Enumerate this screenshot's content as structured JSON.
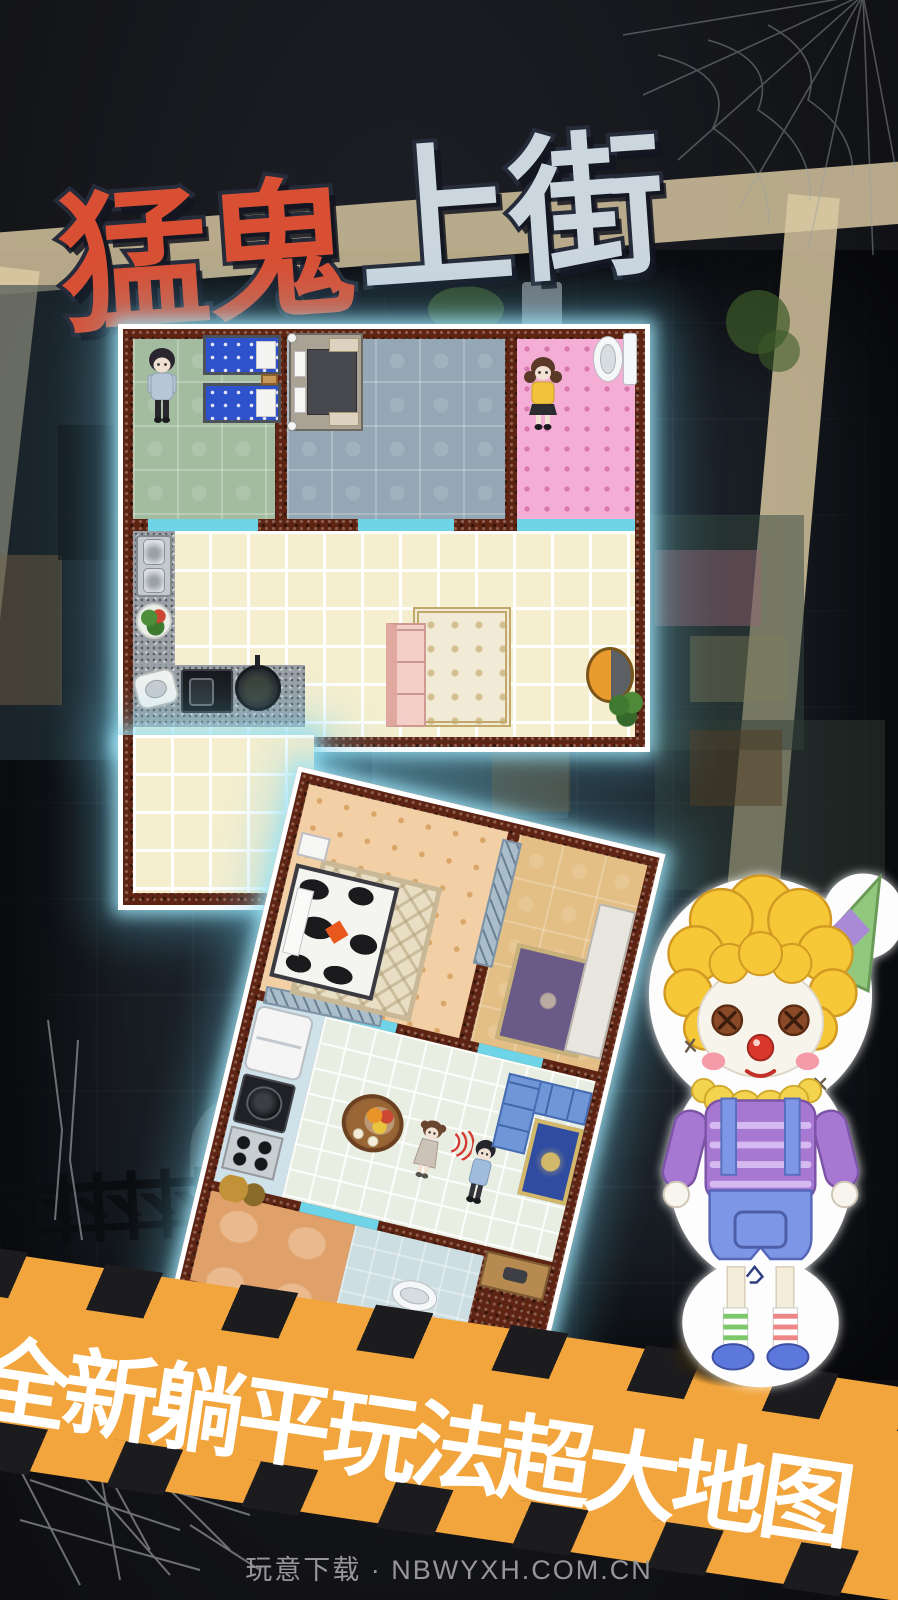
{
  "title": {
    "red": "猛鬼",
    "silver": "上街"
  },
  "banner": {
    "text": "全新躺平玩法超大地图"
  },
  "footer": {
    "text": "玩意下载 · NBWYXH.COM.CN"
  },
  "colors": {
    "bg": "#15161a",
    "banner_orange": "#f2a53c",
    "dash": "#1c1c1f",
    "title_red": "#d94f33",
    "title_silver": "#ccd6df",
    "title_outline": "#262b3a",
    "wall": "#5d2414",
    "road": "#dccba2",
    "moon": "#f2cf3b",
    "room_green": "#a3bca0",
    "room_bluegrey": "#93a7b4",
    "room_pink": "#f4aed6",
    "room_cream": "#f6efcf",
    "room_peach": "#f2cfa4",
    "room_tan": "#e4bf85",
    "room_mint": "#e9eee2",
    "room_orange": "#dfa06a",
    "room_lightblue": "#cddee2",
    "kitchen_blue": "#cfe2e9",
    "footer_grey": "#97979b"
  },
  "scene": {
    "moon": "crescent-moon",
    "plan1_rooms": [
      "kids-bedroom",
      "master-bedroom",
      "pink-bathroom",
      "kitchen-living-room"
    ],
    "plan2_rooms": [
      "peach-bedroom",
      "tan-bedroom",
      "kitchen-strip",
      "dining-room",
      "orange-room",
      "bathroom"
    ],
    "characters": [
      "boy-in-hoodie",
      "girl-in-yellow",
      "girl-in-dress",
      "boy-in-blue",
      "clown-doll"
    ]
  }
}
